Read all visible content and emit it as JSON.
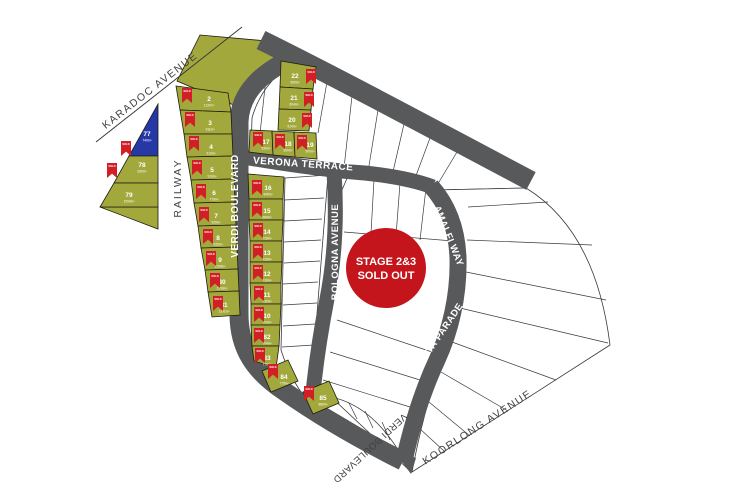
{
  "map": {
    "flag_label": "SOLD",
    "badge": {
      "line1": "STAGE 2&3",
      "line2": "SOLD OUT",
      "cx": 386,
      "cy": 268,
      "r": 40
    },
    "colors": {
      "road": "#58595b",
      "lot_sold_fill": "#a2a83c",
      "lot_held_fill": "#2638a6",
      "lot_available_fill": "#ffffff",
      "flag": "#d21f26",
      "badge": "#c4151c",
      "line": "#3a3a3c",
      "lot_stroke": "#1c1c0e",
      "road_text": "#ffffff",
      "dark_text": "#414042"
    },
    "streets": [
      {
        "id": "karadoc-avenue",
        "name": "KARADOC AVENUE",
        "x": 152,
        "y": 93,
        "rot": -38,
        "tone": "dark",
        "size": 10.5,
        "spacing": 1.5
      },
      {
        "id": "railway",
        "name": "RAILWAY",
        "x": 181,
        "y": 188,
        "rot": -90,
        "tone": "dark",
        "size": 10.5,
        "spacing": 2
      },
      {
        "id": "verdi-boulevard-west",
        "name": "VERDI BOULEVARD",
        "x": 238,
        "y": 206,
        "rot": -90,
        "tone": "light",
        "size": 10,
        "spacing": 0.5
      },
      {
        "id": "verdi-boulevard-top",
        "name": "VERDI BOULEVARD",
        "x": 447,
        "y": 111,
        "rot": 27.5,
        "tone": "light",
        "size": 10,
        "spacing": 0.5
      },
      {
        "id": "verona-terrace",
        "name": "VERONA TERRACE",
        "x": 303,
        "y": 167,
        "rot": 4,
        "tone": "light",
        "size": 10,
        "spacing": 0.5
      },
      {
        "id": "bologna-avenue",
        "name": "BOLOGNA AVENUE",
        "x": 338,
        "y": 252,
        "rot": -90,
        "tone": "light",
        "size": 9.5,
        "spacing": 0.5
      },
      {
        "id": "amalfi-way",
        "name": "AMALFI WAY",
        "x": 446,
        "y": 237,
        "rot": 68,
        "tone": "light",
        "size": 9.5,
        "spacing": 0.5
      },
      {
        "id": "pianta-parade",
        "name": "PIANTA PARADE",
        "x": 440,
        "y": 340,
        "rot": -56,
        "tone": "light",
        "size": 9.5,
        "spacing": 0.5
      },
      {
        "id": "koorlong-avenue",
        "name": "KOORLONG AVENUE",
        "x": 479,
        "y": 430,
        "rot": -33,
        "tone": "dark",
        "size": 10.5,
        "spacing": 1.5
      },
      {
        "id": "verdi-boulevard-bottom",
        "name": "VERDI BOULEVARD",
        "x": 368,
        "y": 446,
        "rot": 137,
        "tone": "dark",
        "size": 9.5,
        "spacing": 0.5
      }
    ],
    "roads": [
      {
        "id": "verdi-boulevard-top",
        "path": "M261,40 C330,74 420,122 531,181",
        "width": 20
      },
      {
        "id": "verdi-boulevard-west",
        "path": "M295,57 C262,72 240,92 239,122 L239,314 C239,348 254,371 284,391 C318,415 357,438 403,461",
        "width": 19
      },
      {
        "id": "verona-terrace",
        "path": "M243,157 C285,164 335,171 365,173 C393,176 417,181 433,187",
        "width": 15
      },
      {
        "id": "bologna-avenue",
        "path": "M334,172 C337,215 335,258 327,299 C321,330 315,368 312,404",
        "width": 15
      },
      {
        "id": "amalfi-pianta",
        "path": "M431,186 C447,204 457,228 458,258 C459,296 450,332 437,360 C424,388 413,420 404,461",
        "width": 17
      }
    ],
    "road_junction_patch": "M393,450 L416,458 L411,474 Z",
    "boundary_lines": [
      {
        "name": "karadoc-avenue-line",
        "path": "M96,142 L242,27"
      }
    ],
    "white_regions": [
      {
        "name": "stage23-region-north-fan",
        "path": "M294,62 L526,188 L434,190 C385,182 345,174 332,168 L251,154 L252,118 C258,96 272,76 294,62 Z"
      },
      {
        "name": "stage23-region-east-fan",
        "path": "M526,188 C570,215 600,265 610,345 L412,472 C420,430 428,400 440,365 C452,335 461,300 462,262 C462,235 452,208 436,190 Z"
      },
      {
        "name": "stage23-region-middle",
        "path": "M348,176 L432,187 C446,206 454,230 455,260 C454,298 446,332 434,360 C422,390 412,420 406,455 L318,403 C325,330 334,250 342,190 Z"
      },
      {
        "name": "stage23-region-strip",
        "path": "M285,178 L328,175 L310,402 C300,394 288,372 281,350 Z"
      },
      {
        "name": "stage23-region-south-sliver",
        "path": "M331,397 L409,470 C399,449 389,435 377,423 C362,408 346,400 331,397 Z"
      }
    ],
    "partition_lines": [
      "M327,82 L318,133",
      "M352,96 L344,168",
      "M378,110 L368,172",
      "M404,124 L392,176",
      "M430,138 L414,181",
      "M457,152 L436,187",
      "M266,78 L258,152",
      "M468,207 L548,202",
      "M467,240 L592,245",
      "M466,272 L606,300",
      "M460,308 L608,343",
      "M452,342 L556,380",
      "M441,372 L508,411",
      "M429,402 L470,436",
      "M419,428 L444,451",
      "M344,232 L453,241",
      "M374,180 L371,233",
      "M400,183 L396,236",
      "M426,188 L420,240",
      "M337,320 L432,352",
      "M330,352 L420,380",
      "M323,380 L410,407",
      "M284,200 L324,198",
      "M284,221 L322,219",
      "M284,242 L321,240",
      "M284,263 L320,261",
      "M283,284 L318,282",
      "M283,305 L317,303",
      "M283,326 L315,324",
      "M282,347 L314,345",
      "M349,403 L357,419",
      "M365,411 L373,428",
      "M382,422 L390,440"
    ],
    "green_shapes": [
      {
        "name": "open-space-north",
        "points": "200,35 267,41 295,60 236,106 177,81"
      },
      {
        "name": "railway-triangle-sliver",
        "points": "100,207 158,207 158,229"
      }
    ],
    "lots": [
      {
        "n": "2",
        "s": "1137m²",
        "st": "sold",
        "poly": "176,86 228,93 231,112 180,110",
        "nx": 209,
        "ny": 101,
        "fx": 182,
        "fy": 88
      },
      {
        "n": "3",
        "s": "911m²",
        "st": "sold",
        "poly": "180,110 231,112 232,134 184,134",
        "nx": 210,
        "ny": 125,
        "fx": 185,
        "fy": 112
      },
      {
        "n": "4",
        "s": "910m²",
        "st": "sold",
        "poly": "184,134 232,134 233,156 187,157",
        "nx": 211,
        "ny": 149,
        "fx": 189,
        "fy": 136
      },
      {
        "n": "5",
        "s": "910m²",
        "st": "sold",
        "poly": "187,157 233,156 234,179 191,180",
        "nx": 212,
        "ny": 172,
        "fx": 192,
        "fy": 160
      },
      {
        "n": "6",
        "s": "779m²",
        "st": "sold",
        "poly": "191,180 234,179 235,202 194,203",
        "nx": 214,
        "ny": 195,
        "fx": 196,
        "fy": 184
      },
      {
        "n": "7",
        "s": "929m²",
        "st": "sold",
        "poly": "194,203 235,202 236,225 198,226",
        "nx": 216,
        "ny": 218,
        "fx": 199,
        "fy": 207
      },
      {
        "n": "8",
        "s": "926m²",
        "st": "sold",
        "poly": "198,226 236,225 237,247 201,248",
        "nx": 218,
        "ny": 240,
        "fx": 203,
        "fy": 229
      },
      {
        "n": "9",
        "s": "1290m²",
        "st": "sold",
        "poly": "201,248 237,247 238,269 205,270",
        "nx": 220,
        "ny": 262,
        "fx": 206,
        "fy": 251
      },
      {
        "n": "80",
        "s": "1290m²",
        "st": "sold",
        "poly": "205,270 238,269 239,291 208,292",
        "nx": 222,
        "ny": 284,
        "fx": 210,
        "fy": 273
      },
      {
        "n": "81",
        "s": "1291m²",
        "st": "sold",
        "poly": "208,292 239,291 240,315 212,317",
        "nx": 224,
        "ny": 307,
        "fx": 213,
        "fy": 296
      },
      {
        "n": "16",
        "s": "845m²",
        "st": "sold",
        "poly": "248,174 284,177 283,199 249,199",
        "nx": 268,
        "ny": 190,
        "fx": 252,
        "fy": 180
      },
      {
        "n": "15",
        "s": "689m²",
        "st": "sold",
        "poly": "249,199 283,199 283,220 249,220",
        "nx": 267,
        "ny": 213,
        "fx": 252,
        "fy": 202
      },
      {
        "n": "14",
        "s": "728m²",
        "st": "sold",
        "poly": "249,220 283,220 282,241 250,241",
        "nx": 267,
        "ny": 234,
        "fx": 253,
        "fy": 223
      },
      {
        "n": "13",
        "s": "728m²",
        "st": "sold",
        "poly": "250,241 282,241 282,262 250,262",
        "nx": 267,
        "ny": 255,
        "fx": 253,
        "fy": 244
      },
      {
        "n": "12",
        "s": "730m²",
        "st": "sold",
        "poly": "250,262 282,262 281,283 250,283",
        "nx": 267,
        "ny": 276,
        "fx": 253,
        "fy": 265
      },
      {
        "n": "11",
        "s": "730m²",
        "st": "sold",
        "poly": "250,283 281,283 281,304 251,304",
        "nx": 267,
        "ny": 297,
        "fx": 254,
        "fy": 286
      },
      {
        "n": "10",
        "s": "700m²",
        "st": "sold",
        "poly": "251,304 281,304 280,325 251,325",
        "nx": 267,
        "ny": 318,
        "fx": 254,
        "fy": 307
      },
      {
        "n": "82",
        "s": "704m²",
        "st": "sold",
        "poly": "251,325 280,325 279,346 252,346",
        "nx": 267,
        "ny": 339,
        "fx": 254,
        "fy": 328
      },
      {
        "n": "83",
        "s": "771m²",
        "st": "sold",
        "poly": "252,346 279,346 276,368 254,361",
        "nx": 267,
        "ny": 360,
        "fx": 255,
        "fy": 348
      },
      {
        "n": "84",
        "s": "775m²",
        "st": "sold",
        "poly": "262,371 288,360 298,381 271,392",
        "nx": 284,
        "ny": 379,
        "fx": 268,
        "fy": 364
      },
      {
        "n": "85",
        "s": "880m²",
        "st": "sold",
        "poly": "303,392 329,381 339,403 313,414",
        "nx": 323,
        "ny": 400,
        "fx": 304,
        "fy": 386
      },
      {
        "n": "22",
        "s": "650m²",
        "st": "sold",
        "poly": "281,61 316,67 313,89 280,87",
        "nx": 295,
        "ny": 78,
        "fx": 306,
        "fy": 69
      },
      {
        "n": "21",
        "s": "604m²",
        "st": "sold",
        "poly": "280,87 313,89 311,110 279,109",
        "nx": 294,
        "ny": 100,
        "fx": 304,
        "fy": 92
      },
      {
        "n": "20",
        "s": "814m²",
        "st": "sold",
        "poly": "279,109 311,110 309,131 278,130",
        "nx": 292,
        "ny": 122,
        "fx": 302,
        "fy": 113
      },
      {
        "n": "17",
        "s": "536m²",
        "st": "sold",
        "poly": "250,130 272,131 273,155 249,152",
        "nx": 266,
        "ny": 144,
        "fx": 253,
        "fy": 132
      },
      {
        "n": "18",
        "s": "500m²",
        "st": "sold",
        "poly": "272,131 294,132 295,157 273,155",
        "nx": 288,
        "ny": 146,
        "fx": 275,
        "fy": 134
      },
      {
        "n": "19",
        "s": "500m²",
        "st": "sold",
        "poly": "294,132 316,133 317,159 295,157",
        "nx": 310,
        "ny": 147,
        "fx": 297,
        "fy": 135
      },
      {
        "n": "77",
        "s": "749m²",
        "st": "held",
        "poly": "158,104 158,156 129,156",
        "nx": 147,
        "ny": 136
      },
      {
        "n": "78",
        "s": "630m²",
        "st": "sold",
        "poly": "129,156 158,156 158,183 114,183",
        "nx": 142,
        "ny": 167,
        "fx": 121,
        "fy": 141
      },
      {
        "n": "79",
        "s": "1050m²",
        "st": "sold",
        "poly": "114,183 158,183 158,207 100,207",
        "nx": 129,
        "ny": 197,
        "fx": 107,
        "fy": 163
      }
    ]
  }
}
